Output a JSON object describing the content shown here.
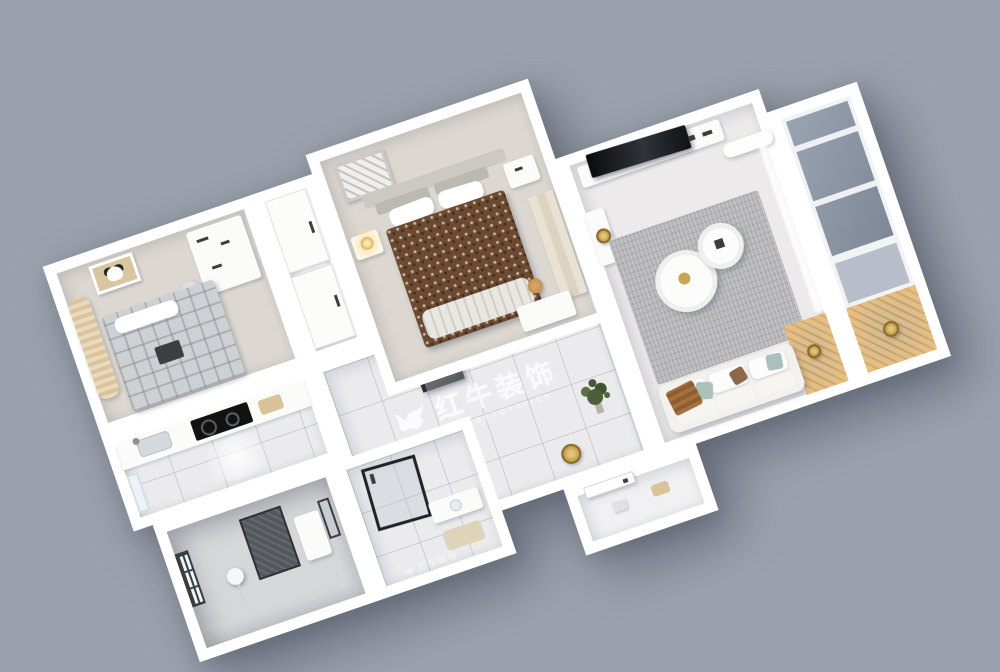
{
  "scene": {
    "description": "3D isometric rendered floor plan of a two-bedroom apartment, rotated on a grey backdrop",
    "background_color": "#9aa1ac",
    "rotation_deg": -19,
    "colors": {
      "wall": "#ffffff",
      "floor_tile": "#ebebee",
      "bedroom_carpet": "#dcd7d0",
      "master_bed_brown": "#6b4a31",
      "plaid_bed_grey": "#cdd1d4",
      "rug_grey": "#b5b5b7",
      "sofa_white": "#f2f1ee",
      "balcony_glass": "#8d96a4",
      "warm_wood_floor": "#d9bd90",
      "gold_accent": "#c8a556",
      "plant_green": "#4c5f3b",
      "tv_black": "#121212",
      "dark_fixture": "#54575b"
    }
  },
  "watermark": {
    "logo": "bull-logo",
    "title": "红牛装饰",
    "subtitle": "HONG NIU DECORATION",
    "color": "#ffffff"
  },
  "rooms": [
    {
      "name": "second-bedroom",
      "furniture": [
        "wicker-wardrobe",
        "panda-wall-art",
        "plaid-bed",
        "pillow",
        "study-desk",
        "desk-chair"
      ]
    },
    {
      "name": "wardrobe-closet",
      "furniture": [
        "sliding-door",
        "sliding-door"
      ]
    },
    {
      "name": "master-bedroom",
      "furniture": [
        "wall-art",
        "headboard",
        "back-cushions",
        "pillows",
        "double-bed-brown",
        "nightstand-left",
        "gold-lamp",
        "nightstand-right",
        "wardrobe",
        "vanity-desk",
        "stool"
      ]
    },
    {
      "name": "living-room",
      "furniture": [
        "tv-console",
        "tv",
        "air-conditioner",
        "sideboard",
        "gold-plate-decor",
        "area-rug",
        "coffee-table-large",
        "coffee-table-small",
        "sofa",
        "seat-cushions",
        "throw-pillows",
        "wood-throw",
        "sheer-curtain",
        "warm-wood-floor",
        "side-table"
      ]
    },
    {
      "name": "balcony",
      "furniture": [
        "glass-panels",
        "lower-window",
        "patterned-floor",
        "round-table"
      ]
    },
    {
      "name": "kitchen",
      "furniture": [
        "counter",
        "sink",
        "faucet",
        "cooktop",
        "cutting-board",
        "window"
      ]
    },
    {
      "name": "bathroom",
      "furniture": [
        "window",
        "floor-lamp",
        "dark-tiled-shower-wall",
        "vanity",
        "mirror"
      ]
    },
    {
      "name": "shower-room",
      "furniture": [
        "glass-shower",
        "sink-counter",
        "bath-mat"
      ]
    },
    {
      "name": "hallway",
      "furniture": [
        "refrigerator",
        "potted-plant",
        "gold-wall-decor"
      ]
    },
    {
      "name": "entry-vestibule",
      "furniture": [
        "entry-door",
        "shoe-decor"
      ]
    }
  ]
}
